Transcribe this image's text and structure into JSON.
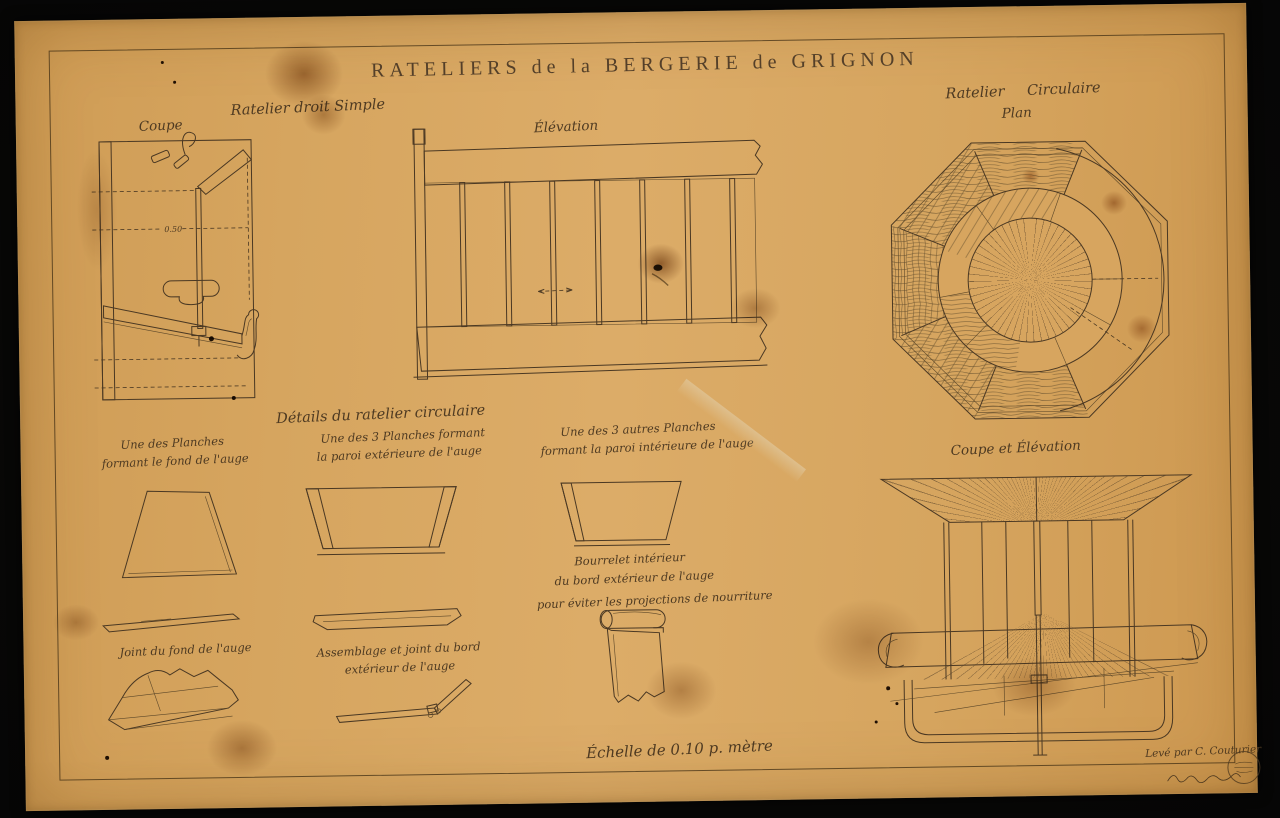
{
  "colors": {
    "background": "#060605",
    "paper": "#d6a55f",
    "ink": "#4a3823"
  },
  "sheet": {
    "title": "RATELIERS de la BERGERIE de GRIGNON",
    "scale_note": "Échelle de 0.10 p. mètre",
    "credit": "Levé par C. Couturier"
  },
  "straight_rack": {
    "heading": "Ratelier droit Simple",
    "section_label": "Coupe",
    "elevation_label": "Élévation",
    "dim_center": "0.50"
  },
  "circular_rack": {
    "heading": "Ratelier Circulaire",
    "plan_label": "Plan",
    "section_label": "Coupe et Élévation"
  },
  "details": {
    "heading": "Détails du ratelier circulaire",
    "bottom_plank": [
      "Une des Planches",
      "formant le fond de l'auge"
    ],
    "outer_plank": [
      "Une des 3 Planches formant",
      "la paroi extérieure de l'auge"
    ],
    "inner_plank": [
      "Une des 3 autres Planches",
      "formant la paroi intérieure de l'auge"
    ],
    "bourrelet": [
      "Bourrelet intérieur",
      "du bord extérieur de l'auge",
      "pour éviter les projections de nourriture"
    ],
    "bottom_joint": "Joint du fond de l'auge",
    "outer_joint": [
      "Assemblage et joint du bord",
      "extérieur de l'auge"
    ]
  }
}
